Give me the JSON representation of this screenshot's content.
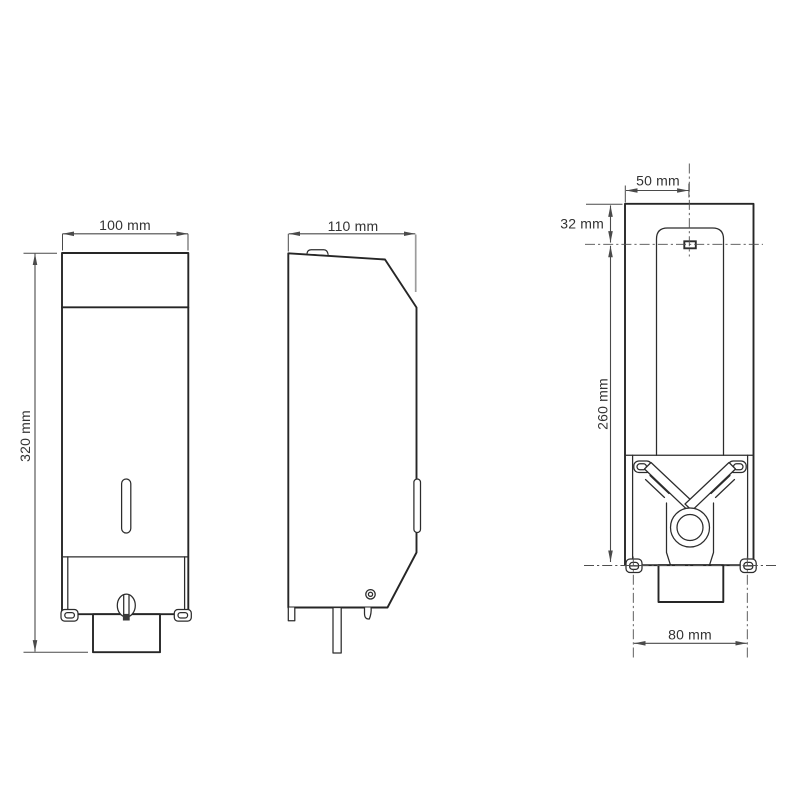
{
  "figure": {
    "views": {
      "front": {
        "width_label": "100 mm",
        "height_label": "320 mm"
      },
      "side": {
        "depth_label": "110 mm"
      },
      "rear": {
        "center_offset_label": "50 mm",
        "top_offset_label": "32 mm",
        "mount_height_label": "260 mm",
        "mount_width_label": "80 mm"
      }
    },
    "colors": {
      "outline": "#262626",
      "dimension": "#4a4a4a",
      "extension_gray": "#9c9c9c",
      "centerline": "#4f4f4f",
      "label_text": "#333333",
      "background": "#ffffff"
    }
  }
}
